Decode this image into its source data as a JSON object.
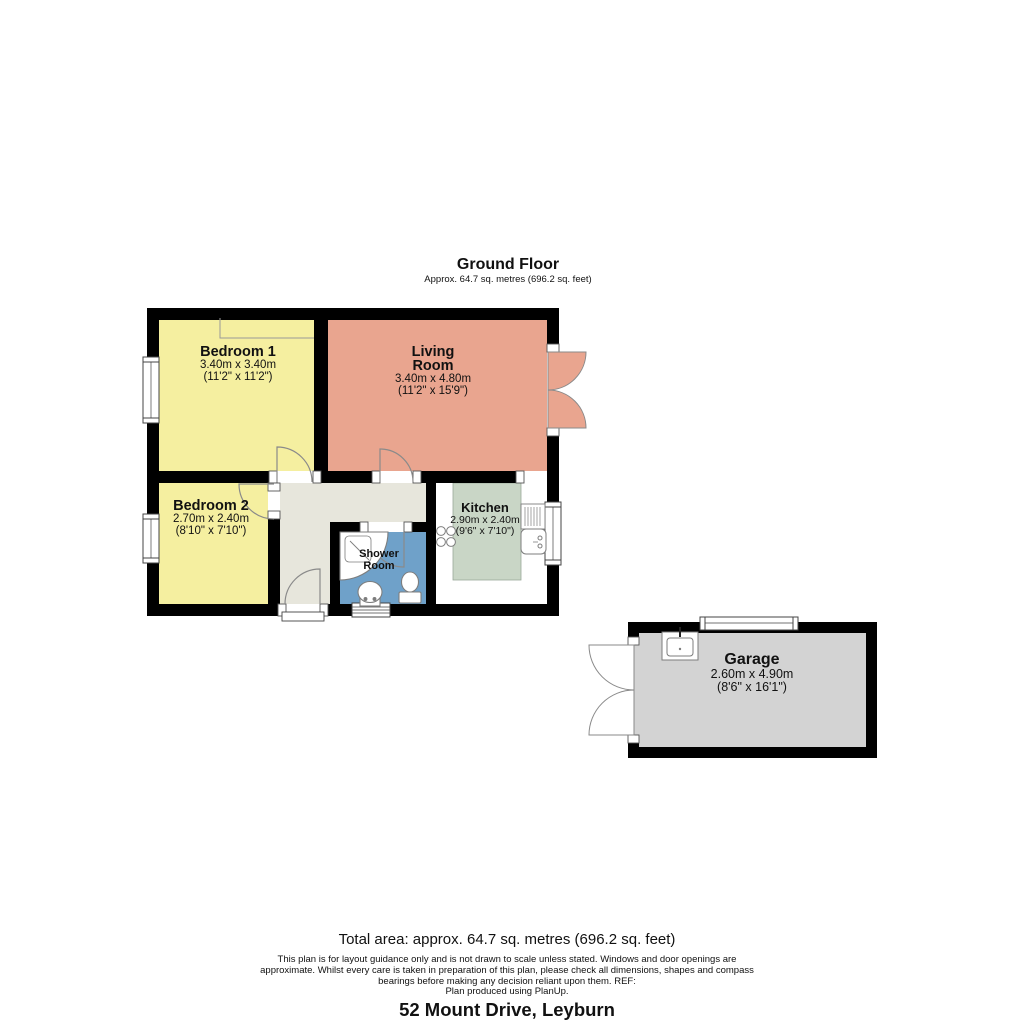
{
  "header": {
    "title": "Ground Floor",
    "subtitle": "Approx. 64.7 sq. metres (696.2 sq. feet)"
  },
  "rooms": {
    "bedroom1": {
      "name": "Bedroom 1",
      "metric": "3.40m x 3.40m",
      "imperial": "(11'2\" x 11'2\")"
    },
    "living": {
      "name": "Living Room",
      "metric": "3.40m x 4.80m",
      "imperial": "(11'2\" x 15'9\")"
    },
    "bedroom2": {
      "name": "Bedroom 2",
      "metric": "2.70m x 2.40m",
      "imperial": "(8'10\" x 7'10\")"
    },
    "kitchen": {
      "name": "Kitchen",
      "metric": "2.90m x 2.40m",
      "imperial": "(9'6\" x 7'10\")"
    },
    "shower": {
      "name": "Shower Room"
    },
    "garage": {
      "name": "Garage",
      "metric": "2.60m x 4.90m",
      "imperial": "(8'6\" x 16'1\")"
    }
  },
  "footer": {
    "total_area": "Total area: approx. 64.7 sq. metres (696.2 sq. feet)",
    "disclaimer": [
      "This plan is for layout guidance only and is not drawn to scale unless stated. Windows and door openings are",
      "approximate. Whilst every care is taken in preparation of this plan, please check all dimensions, shapes and compass",
      "bearings before making any decision reliant upon them. REF:",
      "Plan produced using PlanUp."
    ],
    "address": "52 Mount Drive, Leyburn"
  },
  "colors": {
    "wall": "#000000",
    "bedroom": "#F5EFA0",
    "living": "#E9A58F",
    "kitchen": "#C9D6C6",
    "hall": "#E7E6DC",
    "shower": "#6FA1C9",
    "garage": "#D3D3D3",
    "fixture_stroke": "#7d7d7d"
  }
}
